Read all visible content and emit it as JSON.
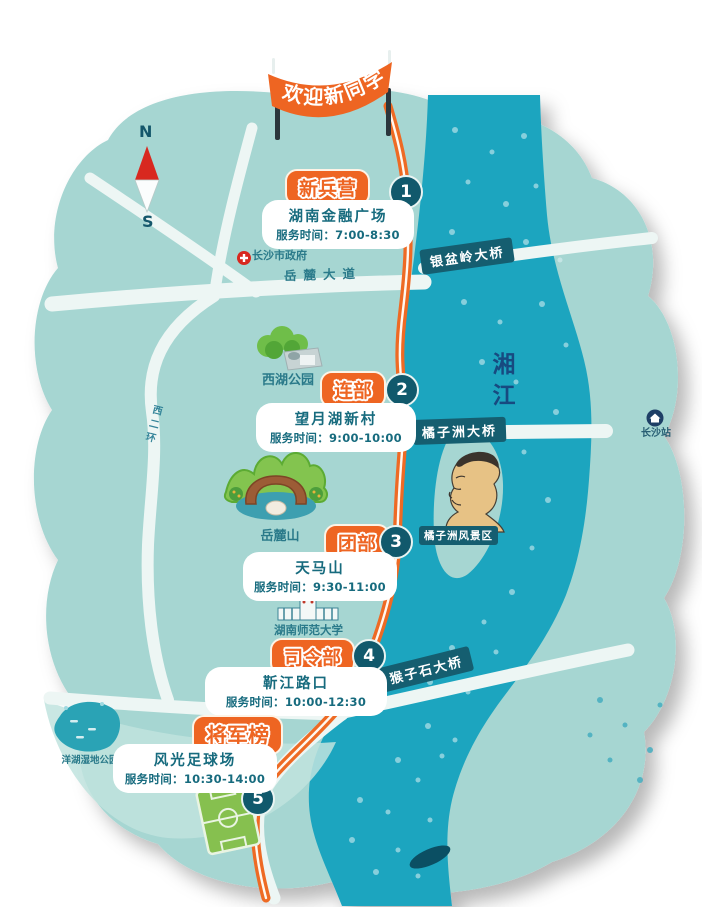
{
  "banner": {
    "text": "欢迎新同学"
  },
  "compass": {
    "north": "N",
    "south": "S"
  },
  "river": {
    "name": "湘江"
  },
  "roads": {
    "yuelu_avenue": "岳麓大道",
    "west_second_ring": "西二环"
  },
  "bridges": {
    "yinpenling": "银盆岭大桥",
    "juzizhou": "橘子洲大桥",
    "houzishi": "猴子石大桥"
  },
  "stops": [
    {
      "num": "1",
      "name": "新兵营",
      "place": "湖南金融广场",
      "time": "服务时间：7:00-8:30"
    },
    {
      "num": "2",
      "name": "连部",
      "place": "望月湖新村",
      "time": "服务时间：9:00-10:00"
    },
    {
      "num": "3",
      "name": "团部",
      "place": "天马山",
      "time": "服务时间：9:30-11:00"
    },
    {
      "num": "4",
      "name": "司令部",
      "place": "靳江路口",
      "time": "服务时间：10:00-12:30"
    },
    {
      "num": "5",
      "name": "将军榜",
      "place": "风光足球场",
      "time": "服务时间：10:30-14:00"
    }
  ],
  "pois": {
    "city_government": "长沙市政府",
    "west_lake_park": "西湖公园",
    "yuelu_mountain": "岳麓山",
    "orange_isle_scenic_area": "橘子洲风景区",
    "hunan_normal_university": "湖南师范大学",
    "changsha_station": "长沙站",
    "yanghu_wetland_park": "洋湖湿地公园"
  },
  "colors": {
    "land_teal": "#a6d6d2",
    "river_teal": "#1ea5bf",
    "dark_teal": "#11596c",
    "accent_orange": "#ee6522",
    "label_teal": "#2a7a8a",
    "river_text_blue": "#174a80",
    "compass_red": "#d8281f"
  }
}
